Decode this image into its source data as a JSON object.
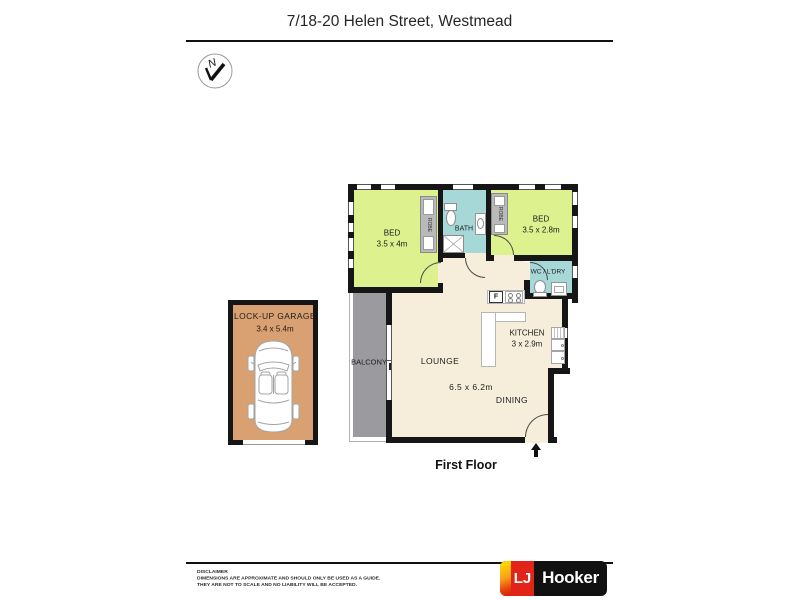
{
  "page": {
    "title": "7/18-20 Helen Street, Westmead",
    "floor_label": "First Floor"
  },
  "compass": {
    "label": "N"
  },
  "rooms": {
    "bed1": {
      "label": "BED",
      "dims": "3.5 x 4m"
    },
    "bed2": {
      "label": "BED",
      "dims": "3.5 x 2.8m"
    },
    "bath": {
      "label": "BATH"
    },
    "wc_laundry": {
      "label": "WC / L'DRY"
    },
    "kitchen": {
      "label": "KITCHEN",
      "dims": "3 x 2.9m"
    },
    "lounge": {
      "label": "LOUNGE"
    },
    "lounge_dining_dims": "6.5 x 6.2m",
    "dining": {
      "label": "DINING"
    },
    "balcony": {
      "label": "BALCONY"
    },
    "garage": {
      "label": "LOCK-UP GARAGE",
      "dims": "3.4 x 5.4m"
    }
  },
  "fixtures": {
    "robe": "ROBE",
    "fridge": "F"
  },
  "footer": {
    "disclaimer_heading": "DISCLAIMER",
    "disclaimer_line1": "DIMENSIONS ARE APPROXIMATE AND SHOULD ONLY BE USED AS A GUIDE.",
    "disclaimer_line2": "THEY ARE NOT TO SCALE AND NO LIABILITY WILL BE ACCEPTED.",
    "brand": {
      "lj": "LJ",
      "hooker": "Hooker"
    }
  },
  "colors": {
    "wall": "#161616",
    "bedroom_fill": "#ddf18e",
    "wet_area_fill": "#a7d8d8",
    "living_fill": "#f6eedb",
    "balcony_fill": "#9b9b9f",
    "garage_fill": "#d9a172",
    "robe_fill": "#b9b9b9",
    "brand_red": "#e2231a",
    "brand_yellow": "#ffd400",
    "brand_black": "#111111"
  }
}
